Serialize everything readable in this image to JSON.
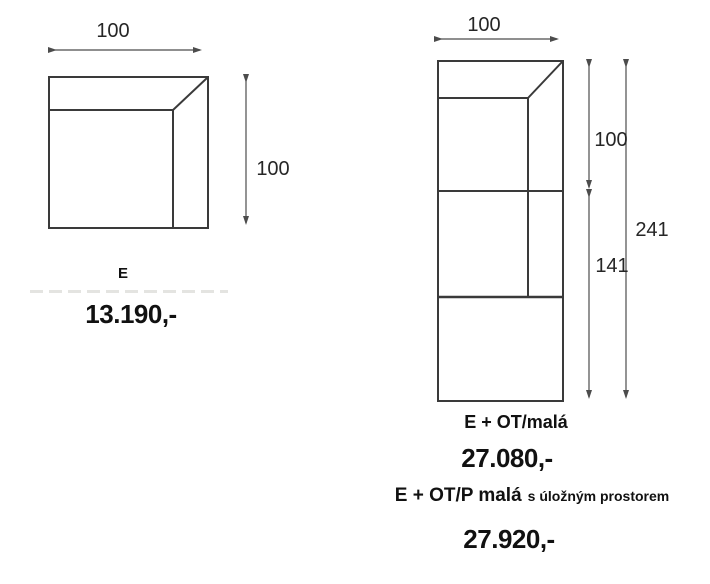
{
  "page": {
    "background_color": "#ffffff",
    "line_color": "#3a3a3a",
    "dim_line_color": "#4c4c4c"
  },
  "products": [
    {
      "label": "E",
      "price": "13.190,-",
      "dimensions": {
        "width": "100",
        "height": "100"
      }
    },
    {
      "label": "E + OT/malá",
      "price": "27.080,-",
      "dimensions": {
        "width": "100",
        "upper": "100",
        "lower": "141",
        "total": "241"
      }
    },
    {
      "label_main": "E + OT/P malá",
      "label_suffix": "s úložným prostorem",
      "price": "27.920,-"
    }
  ]
}
